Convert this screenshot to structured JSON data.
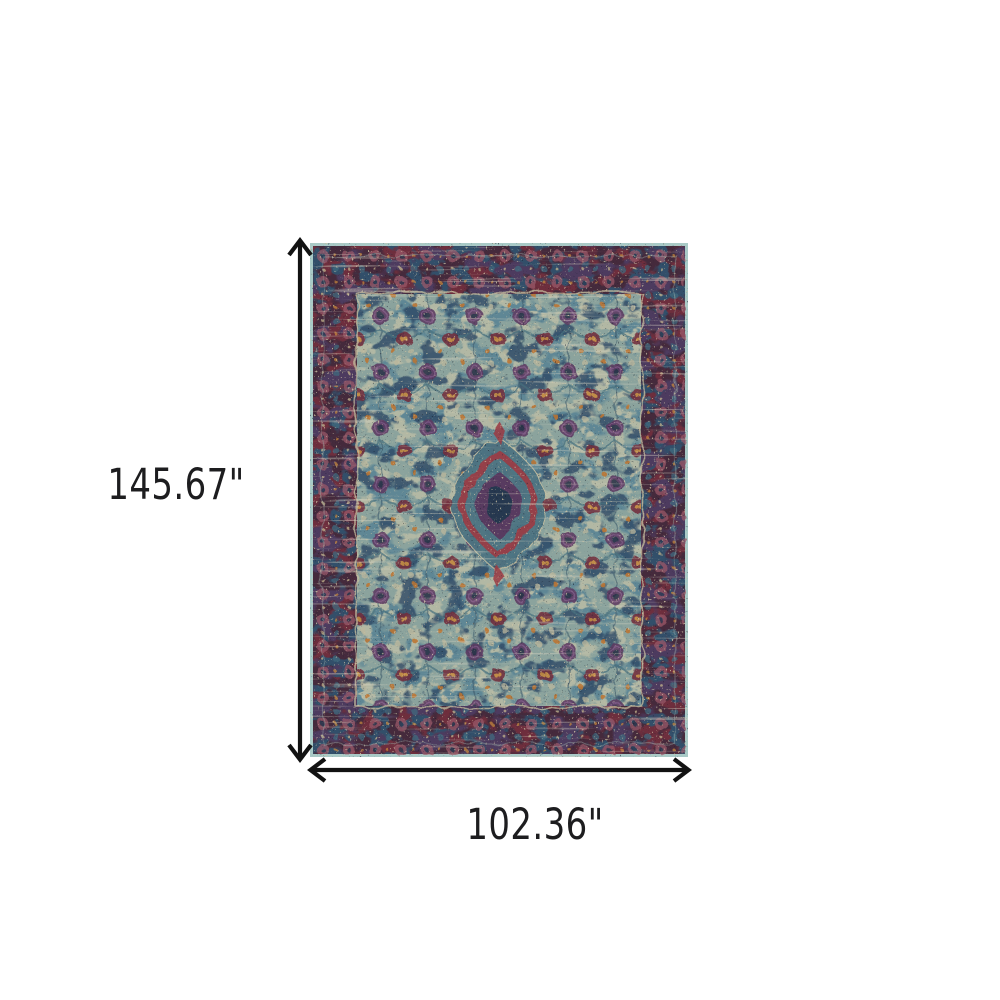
{
  "figure": {
    "subject": "Distressed traditional oriental medallion area rug in blue, purple and red",
    "height_label": "145.67\"",
    "width_label": "102.36\"",
    "height_inches": 145.67,
    "width_inches": 102.36
  },
  "colors": {
    "page-bg": "#ffffff",
    "dimension-line": "#121212",
    "dimension-text": "#1d1d1f",
    "rug-edge": "#a9cac7",
    "rug-border-base": "#452a3c",
    "rug-border-maroon": "#6e2f3d",
    "rug-border-blue": "#33506b",
    "rug-border-purple": "#4d3a5e",
    "rug-guard": "#c6bd9e",
    "rug-field": "#8ba39d",
    "rug-field-teal": "#5f8795",
    "rug-motif-purple": "#5d3a62",
    "rug-motif-maroon": "#732f3e",
    "rug-motif-orange": "#bd7430",
    "rug-motif-navy": "#2f4a66",
    "rug-medallion-teal": "#4e7482",
    "rug-medallion-red": "#9c3b42",
    "rug-medallion-purple": "#5a3760",
    "rug-medallion-core": "#273750",
    "rug-fleck-beige": "#cfc5a6"
  }
}
